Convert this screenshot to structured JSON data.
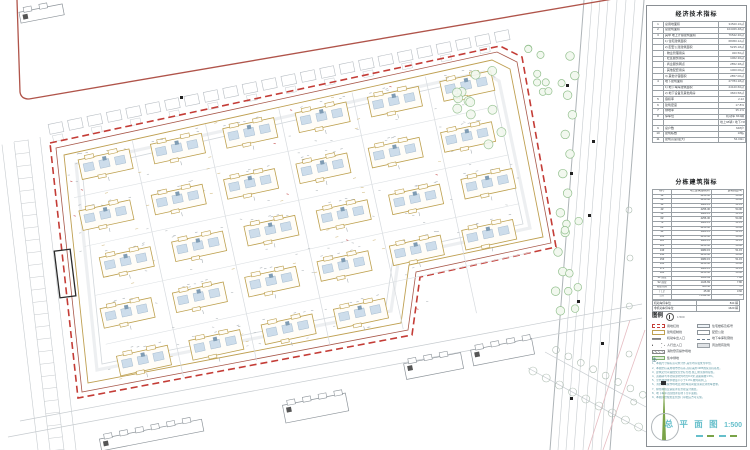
{
  "panel": {
    "table1": {
      "title": "经济技术指标",
      "rows": [
        [
          "1",
          "总用地面积",
          "34520.16㎡"
        ],
        [
          "2",
          "总建筑面积",
          "104326.48㎡"
        ],
        [
          "3",
          "其中 地上计容建筑面积",
          "76542.30㎡"
        ],
        [
          "",
          "1) 住宅建筑面积",
          "68450.12㎡"
        ],
        [
          "",
          "2) 配套公建建筑面积",
          "5235.18㎡"
        ],
        [
          "",
          "· 物业管理用房",
          "320.50㎡"
        ],
        [
          "",
          "· 社区服务用房",
          "1062.30㎡"
        ],
        [
          "",
          "· 商业服务网点",
          "2852.38㎡"
        ],
        [
          "",
          "· 其他配套用房",
          "1000.00㎡"
        ],
        [
          "",
          "3) 其他计容面积",
          "2857.00㎡"
        ],
        [
          "4",
          "地下建筑面积",
          "27784.18㎡"
        ],
        [
          "",
          "1) 地下车库建筑面积",
          "24120.60㎡"
        ],
        [
          "",
          "2) 地下设备及其他用房",
          "3663.58㎡"
        ],
        [
          "5",
          "容积率",
          "2.22"
        ],
        [
          "6",
          "建筑密度",
          "17.8%"
        ],
        [
          "7",
          "绿地率",
          "35.1%"
        ],
        [
          "8",
          "停车位",
          "机动车 844辆"
        ],
        [
          "",
          "",
          "地上98辆 / 地下746辆"
        ],
        [
          "9",
          "总户数",
          "648户"
        ],
        [
          "10",
          "建筑栋数",
          "18栋"
        ],
        [
          "11",
          "建筑高度(最大)",
          "54.00m"
        ]
      ]
    },
    "table2": {
      "title": "分栋建筑指标",
      "headers": [
        "栋号",
        "地上建筑面积(㎡)",
        "建筑高度(m)"
      ],
      "rows": [
        [
          "1#",
          "4256.30",
          "54.00"
        ],
        [
          "2#",
          "4256.30",
          "54.00"
        ],
        [
          "3#",
          "3980.15",
          "51.15"
        ],
        [
          "4#",
          "4256.30",
          "54.00"
        ],
        [
          "5#",
          "3980.15",
          "51.15"
        ],
        [
          "6#",
          "4256.30",
          "54.00"
        ],
        [
          "7#",
          "3980.15",
          "51.15"
        ],
        [
          "8#",
          "4256.30",
          "54.00"
        ],
        [
          "9#",
          "3980.15",
          "51.15"
        ],
        [
          "10#",
          "4256.30",
          "54.00"
        ],
        [
          "11#",
          "3980.15",
          "51.15"
        ],
        [
          "12#",
          "4256.30",
          "54.00"
        ],
        [
          "13#",
          "3980.15",
          "51.15"
        ],
        [
          "14#",
          "4256.30",
          "54.00"
        ],
        [
          "15#",
          "3980.15",
          "51.15"
        ],
        [
          "16#",
          "4256.30",
          "54.00"
        ],
        [
          "17#",
          "3980.15",
          "51.15"
        ],
        [
          "18#",
          "4256.30",
          "54.00"
        ],
        [
          "S1 商业",
          "1426.69",
          "7.80"
        ],
        [
          "S2 商业",
          "1426.69",
          "7.80"
        ],
        [
          "物业用房",
          "320.50",
          "—"
        ],
        [
          "门卫",
          "45.00",
          "3.60"
        ],
        [
          "合计",
          "76542.30",
          "—"
        ]
      ]
    },
    "summary_rows": [
      [
        "机动车停车位",
        "844 辆"
      ],
      [
        "非机动车停车位",
        "1620 辆"
      ]
    ],
    "legend": {
      "title": "图例",
      "scale_note": "1:500",
      "items_left": [
        {
          "sym": "red-dash",
          "label": "用地红线"
        },
        {
          "sym": "olive",
          "label": "建筑控制线"
        },
        {
          "sym": "arrow",
          "label": "机动车出入口"
        },
        {
          "sym": "arrow-open",
          "label": "人行出入口"
        },
        {
          "sym": "hatch",
          "label": "消防登高操作场地"
        },
        {
          "sym": "green",
          "label": "集中绿地"
        }
      ],
      "items_right": [
        {
          "sym": "rect",
          "label": "住宅楼栋及栋号"
        },
        {
          "sym": "rect2",
          "label": "配套公建"
        },
        {
          "sym": "dashdot",
          "label": "地下车库轮廓线"
        },
        {
          "sym": "gray",
          "label": "周边既有建筑"
        }
      ]
    },
    "notes": {
      "label": "注:",
      "lines": [
        "1、本图尺寸除标高以米计外,其余均以毫米为单位。",
        "2、本图坐标采用城市坐标系,高程采用1985国家高程基准。",
        "3、建筑定位以轴线交点坐标为准,施工前须现场复核。",
        "4、道路转弯半径除注明外均为6.0米,道路横坡1.5%。",
        "5、室外场地排水坡度不小于0.3%,坡向雨水口。",
        "6、消防登高操作场地及消防车道荷载须满足消防车要求。",
        "7、绿化种植及铺装详见景观设计图纸。",
        "8、地下车库范围线详见地下室平面图。",
        "9、本图须经规划主管部门审批后方可实施。"
      ]
    },
    "titleblock": {
      "drawing_title": "总 平 面 图",
      "scale": "1:500"
    }
  },
  "plan": {
    "rotation_deg": -12.2,
    "origin": [
      58,
      152
    ],
    "boundary": [
      [
        50,
        143
      ],
      [
        500,
        46
      ],
      [
        522,
        57
      ],
      [
        556,
        247
      ],
      [
        420,
        277
      ],
      [
        412,
        335
      ],
      [
        78,
        398
      ]
    ],
    "boundary_inner": [
      [
        56,
        148
      ],
      [
        497,
        52
      ],
      [
        517,
        62
      ],
      [
        551,
        243
      ],
      [
        416,
        272
      ],
      [
        408,
        330
      ],
      [
        82,
        392
      ]
    ],
    "control_line": [
      [
        64,
        155
      ],
      [
        492,
        60
      ],
      [
        510,
        69
      ],
      [
        543,
        237
      ],
      [
        409,
        265
      ],
      [
        401,
        323
      ],
      [
        88,
        383
      ]
    ],
    "inner_road": [
      [
        76,
        164
      ],
      [
        484,
        72
      ],
      [
        499,
        81
      ],
      [
        530,
        228
      ],
      [
        399,
        256
      ],
      [
        391,
        311
      ],
      [
        97,
        370
      ]
    ],
    "inner_road2": [
      [
        82,
        169
      ],
      [
        479,
        78
      ],
      [
        493,
        86
      ],
      [
        523,
        224
      ],
      [
        394,
        252
      ],
      [
        386,
        306
      ],
      [
        102,
        364
      ]
    ],
    "building_rows": [
      {
        "y": 12,
        "xs": [
          18,
          92,
          166,
          240,
          314,
          388
        ]
      },
      {
        "y": 62,
        "xs": [
          8,
          82,
          156,
          230,
          304,
          378
        ]
      },
      {
        "y": 112,
        "xs": [
          18,
          92,
          166,
          240,
          314,
          388
        ]
      },
      {
        "y": 162,
        "xs": [
          8,
          82,
          156,
          230,
          304,
          378
        ]
      },
      {
        "y": 212,
        "xs": [
          14,
          88,
          162,
          236
        ]
      }
    ],
    "building": {
      "w": 52,
      "h": 20
    },
    "grid_x": [
      75,
      150,
      225,
      300,
      375
    ],
    "grid_y": [
      48,
      98,
      148,
      198
    ],
    "road_right_tops": [
      584,
      592,
      600,
      608,
      617,
      626,
      635,
      644
    ],
    "black_squares": [
      [
        180,
        96
      ],
      [
        566,
        84
      ],
      [
        592,
        140
      ],
      [
        570,
        172
      ],
      [
        588,
        214
      ],
      [
        577,
        300
      ],
      [
        601,
        342
      ],
      [
        570,
        397
      ]
    ],
    "existing_buildings": [
      {
        "x": 284,
        "y": 399,
        "w": 64,
        "h": 22,
        "rot": -11
      },
      {
        "x": 405,
        "y": 358,
        "w": 58,
        "h": 20,
        "rot": -11
      },
      {
        "x": 472,
        "y": 344,
        "w": 62,
        "h": 20,
        "rot": -11
      },
      {
        "x": 100,
        "y": 429,
        "w": 104,
        "h": 16,
        "rot": -11
      },
      {
        "x": 20,
        "y": 8,
        "w": 44,
        "h": 15,
        "rot": -11
      }
    ],
    "colors": {
      "boundary_red": "#c43c36",
      "inner_brown": "#a8584a",
      "control_olive": "#bfa052",
      "building_stroke": "#bda04e",
      "building_fill": "#fffdf8",
      "patch_fill": "#cdddeb",
      "patch_stroke": "#9db4c8",
      "core_blue": "#7f9cb4",
      "tree_green": "#93c08e",
      "tree_fill": "#f2f8ef",
      "road_gray": "#c6cbcf",
      "road_dark": "#aeb4b8",
      "parcel_gray": "#b6bcc2",
      "existing_gray": "#8d949a",
      "speck_gray": "#9aa2a8",
      "pink_line": "#e6bcc2",
      "red_solid": "#b0544a",
      "circle_gray": "#aebdb2"
    }
  }
}
